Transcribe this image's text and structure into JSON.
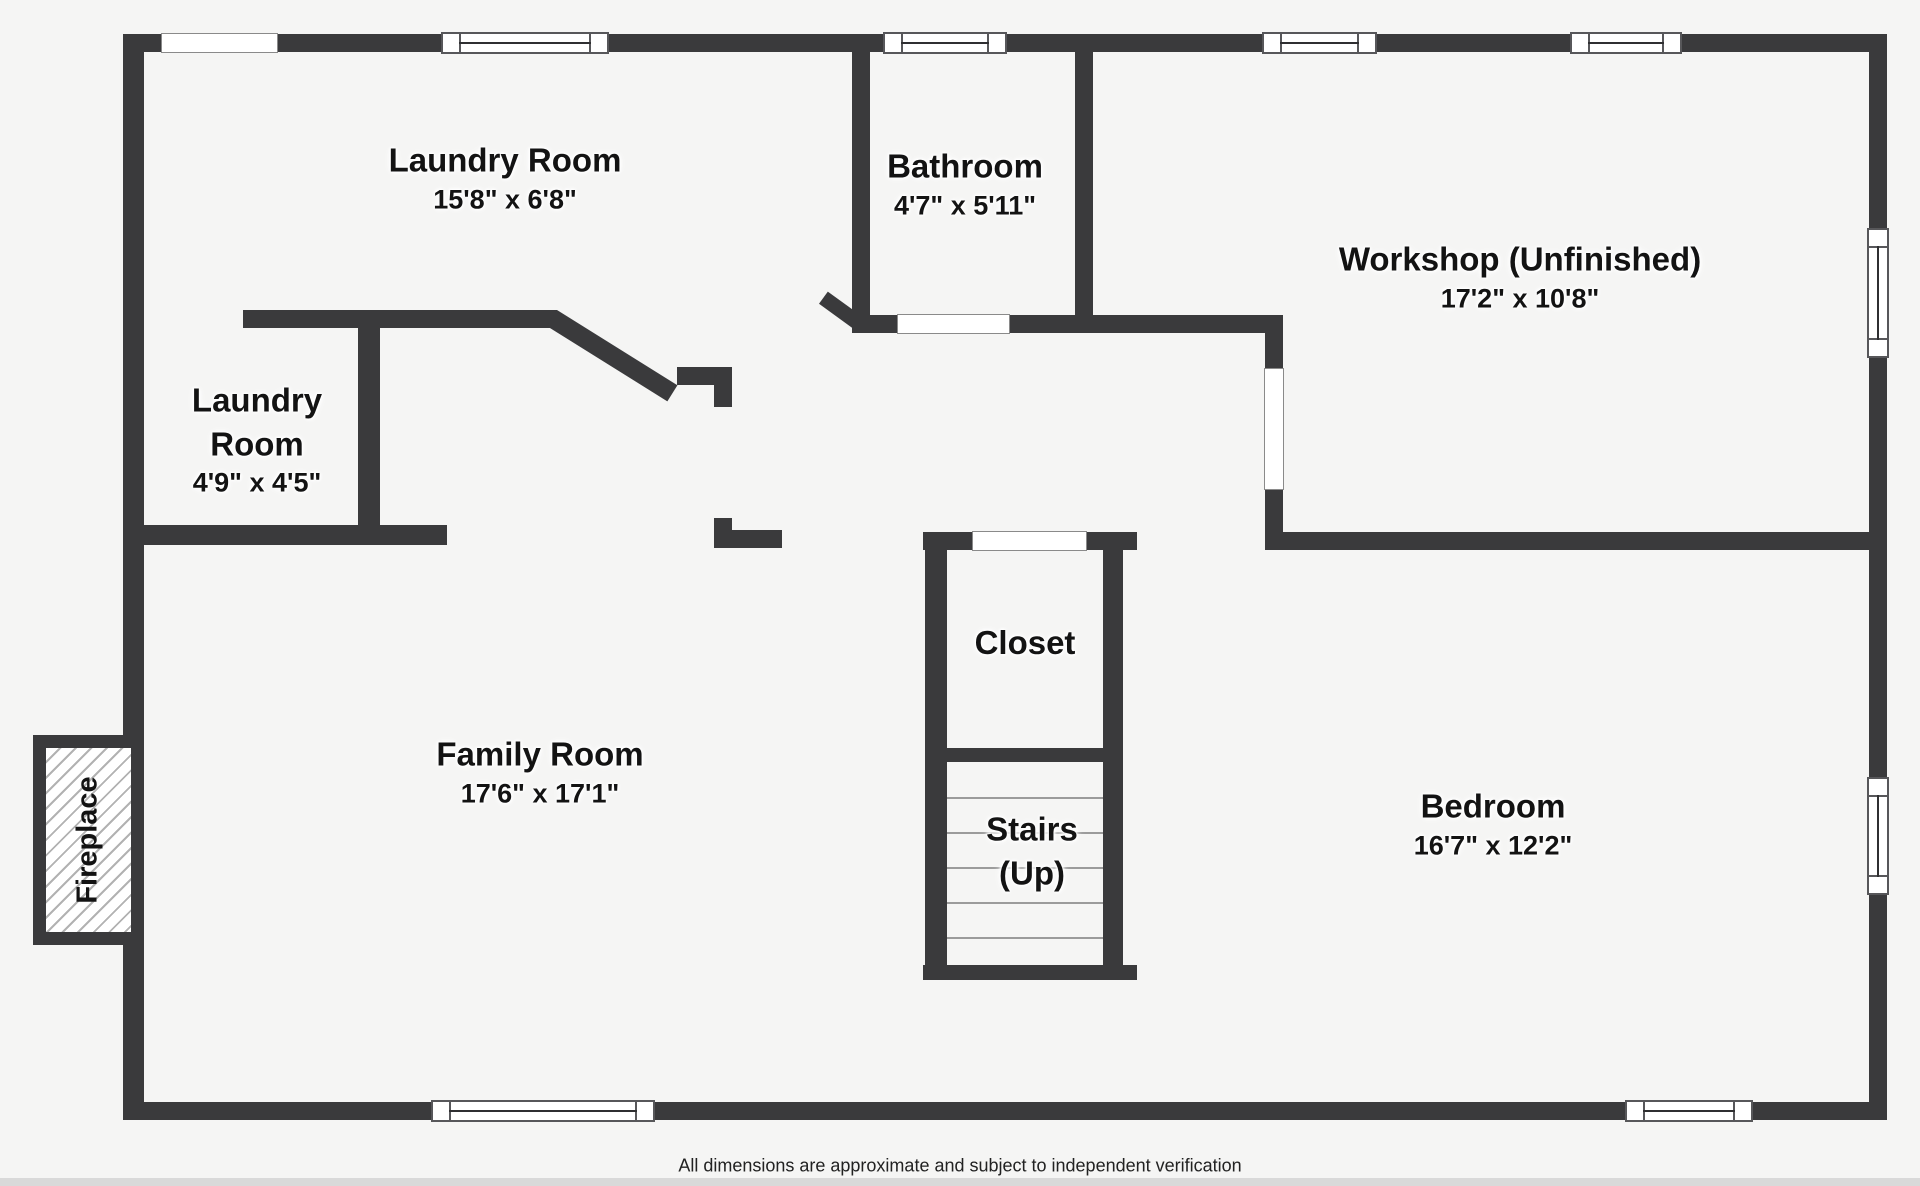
{
  "canvas": {
    "background": "#f5f5f4",
    "wall_color": "#3a3a3c",
    "label_color": "#131313"
  },
  "rooms": {
    "laundry_main": {
      "name": "Laundry Room",
      "dims": "15'8\" x 6'8\""
    },
    "bathroom": {
      "name": "Bathroom",
      "dims": "4'7\" x 5'11\""
    },
    "workshop": {
      "name": "Workshop (Unfinished)",
      "dims": "17'2\" x 10'8\""
    },
    "laundry_small": {
      "line1": "Laundry",
      "line2": "Room",
      "dims": "4'9\" x 4'5\""
    },
    "family": {
      "name": "Family Room",
      "dims": "17'6\" x 17'1\""
    },
    "closet": {
      "name": "Closet"
    },
    "stairs": {
      "line1": "Stairs",
      "line2": "(Up)"
    },
    "bedroom": {
      "name": "Bedroom",
      "dims": "16'7\" x 12'2\""
    },
    "fireplace": {
      "name": "Fireplace"
    }
  },
  "footer": {
    "disclaimer": "All dimensions are approximate and subject to independent verification"
  }
}
